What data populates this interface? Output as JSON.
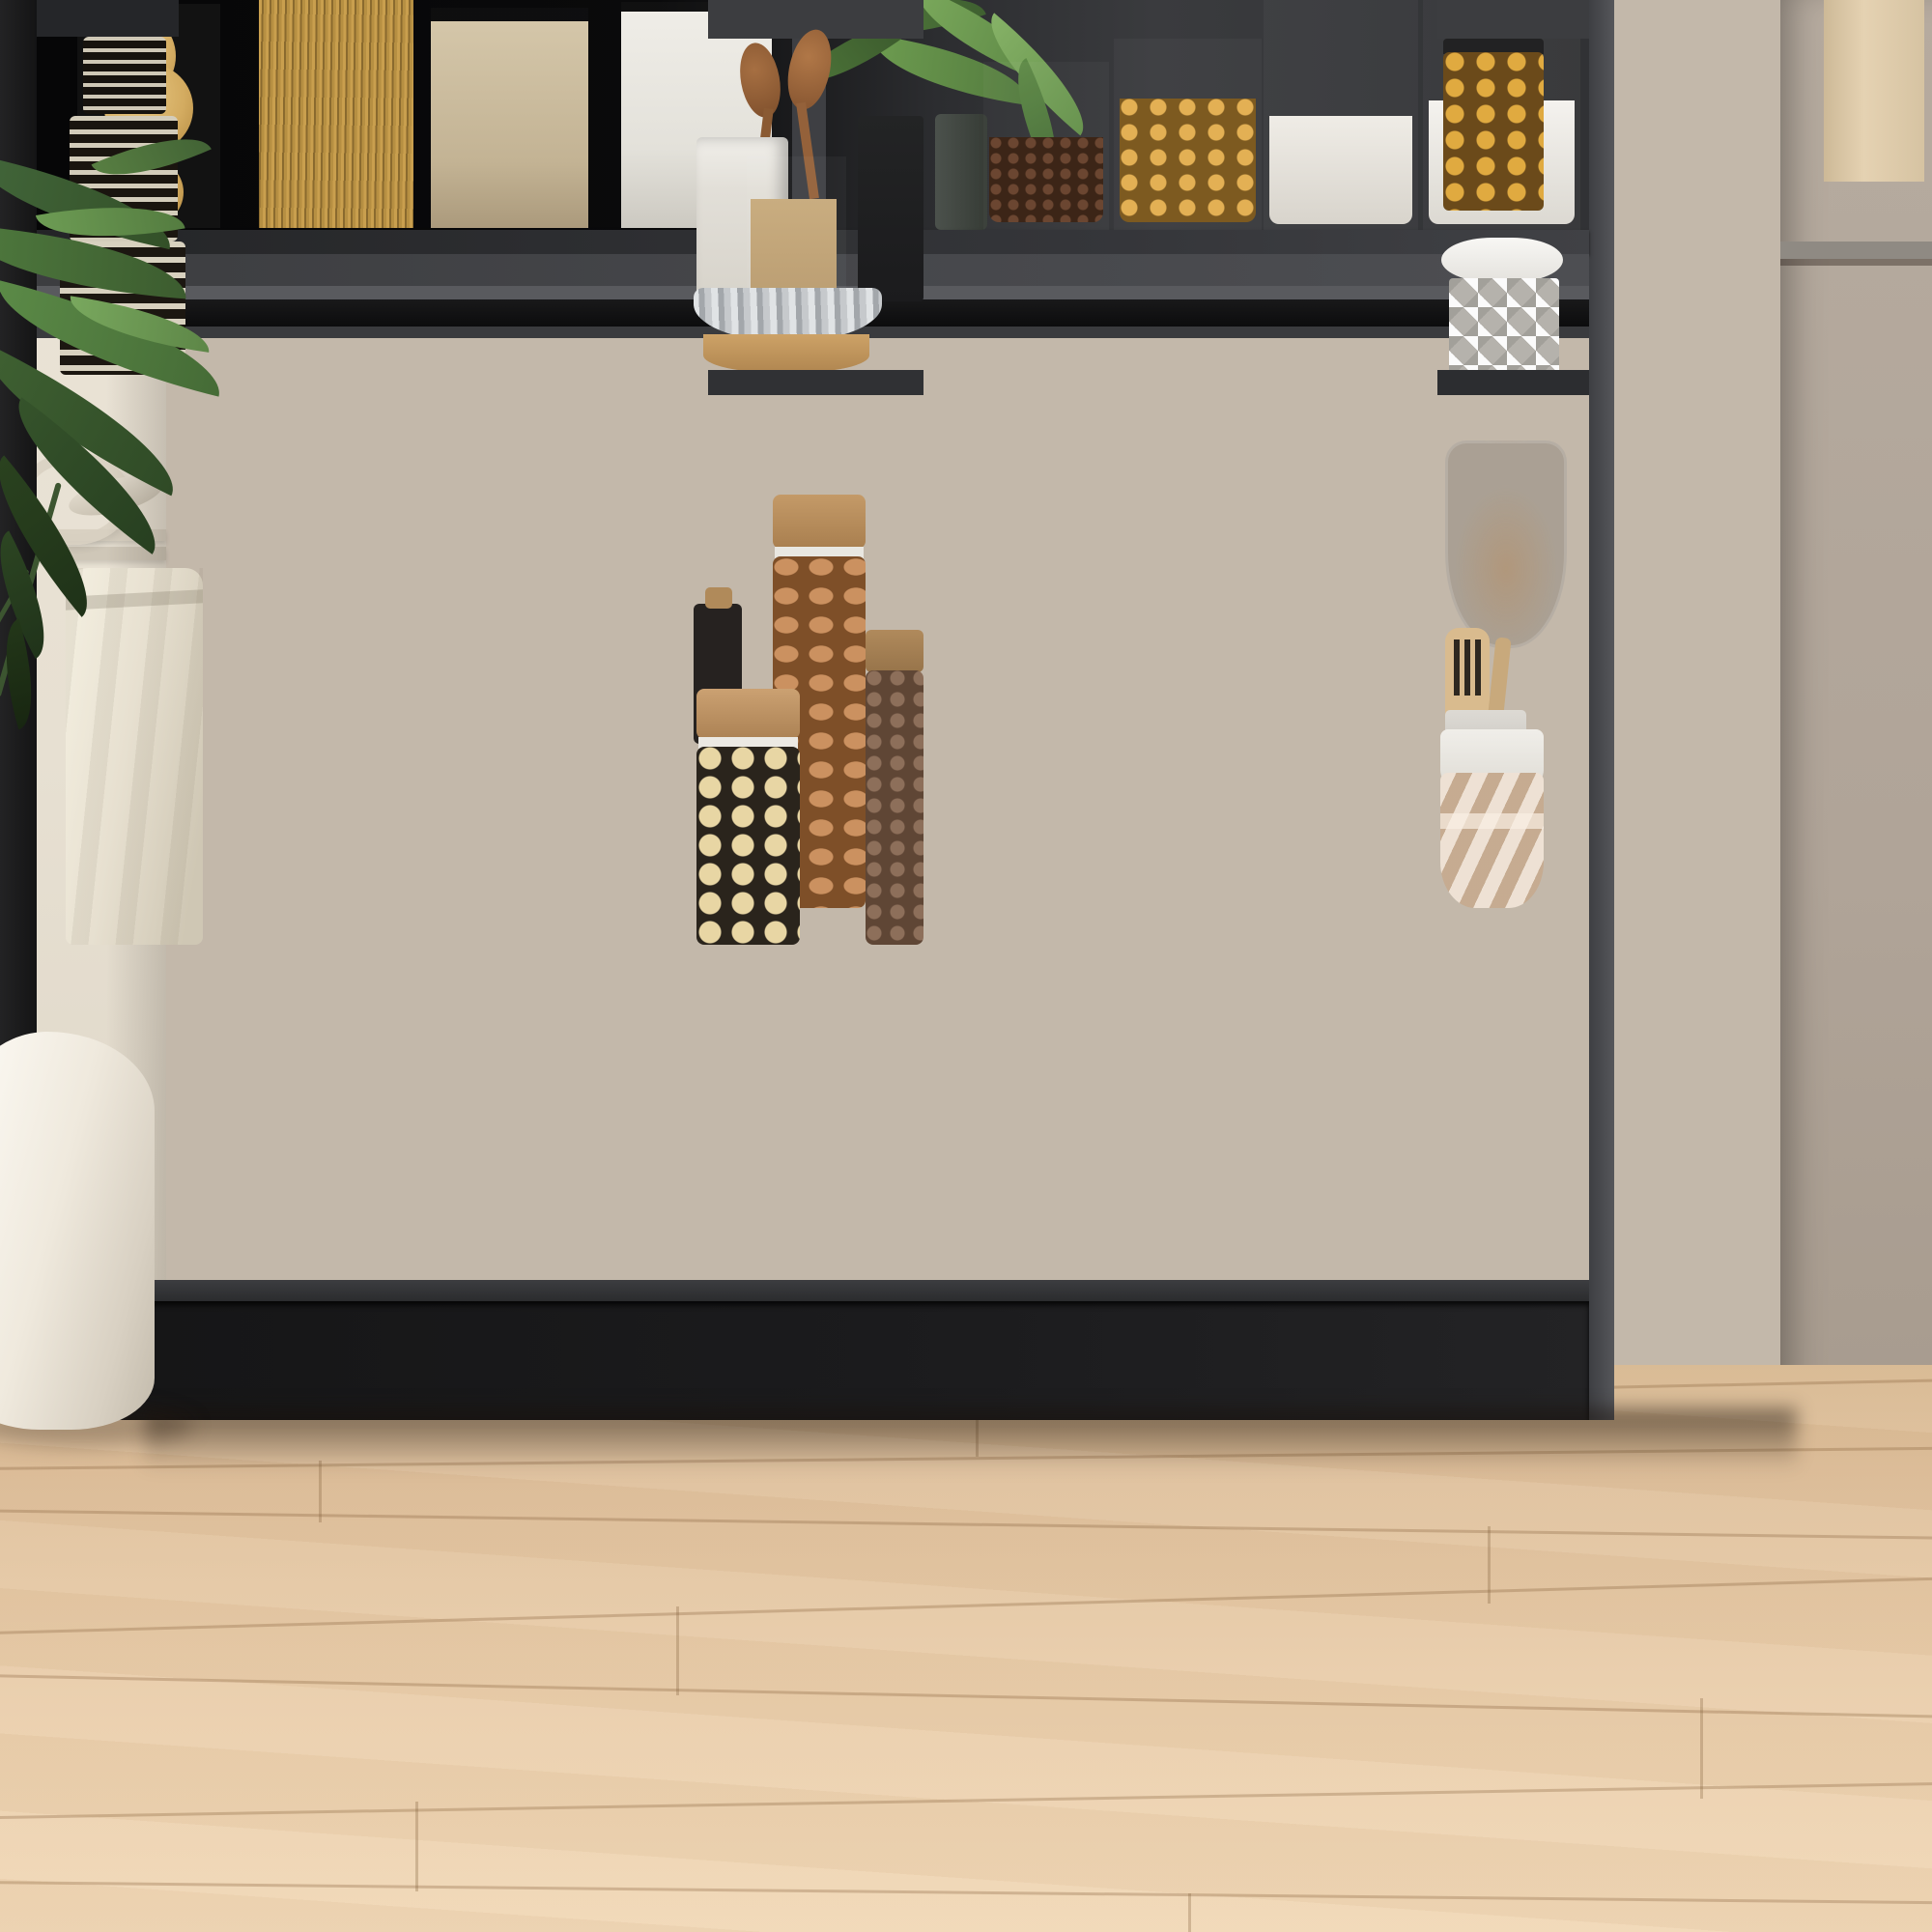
{
  "image_type": "product-photo-with-annotations",
  "caption": {
    "text": "2 SCHIEBETÜREN",
    "color": "#34383d"
  },
  "overlay": {
    "measurement_label": "6,4 cm",
    "columns": [
      {
        "labels": [
          "6,4 cm",
          "6,4 cm",
          "6,4 cm",
          "6,4 cm"
        ]
      },
      {
        "labels": [
          "6,4 cm",
          "6,4 cm",
          "6,4 cm",
          "6,4 cm"
        ]
      },
      {
        "labels": [
          "6,4 cm",
          "6,4 cm",
          "6,4 cm",
          "6,4 cm"
        ]
      }
    ],
    "icons": {
      "up_arrow": "arrow-up-icon",
      "down_arrow": "arrow-down-icon"
    },
    "colors": {
      "label": "#ffffff",
      "dashed_border": "rgba(255,255,255,0.85)",
      "dashed_fill": "rgba(255,255,255,0.22)",
      "solid_border": "rgba(255,255,255,0.9)",
      "solid_fill": "rgba(255,255,255,0.34)"
    }
  },
  "palette": {
    "cabinet_black": "#121213",
    "door_gray": "#3e3f42",
    "wall_left": "#e8e1d4",
    "wall_right": "#b0a498",
    "floor_wood": "#e2c5a2"
  }
}
